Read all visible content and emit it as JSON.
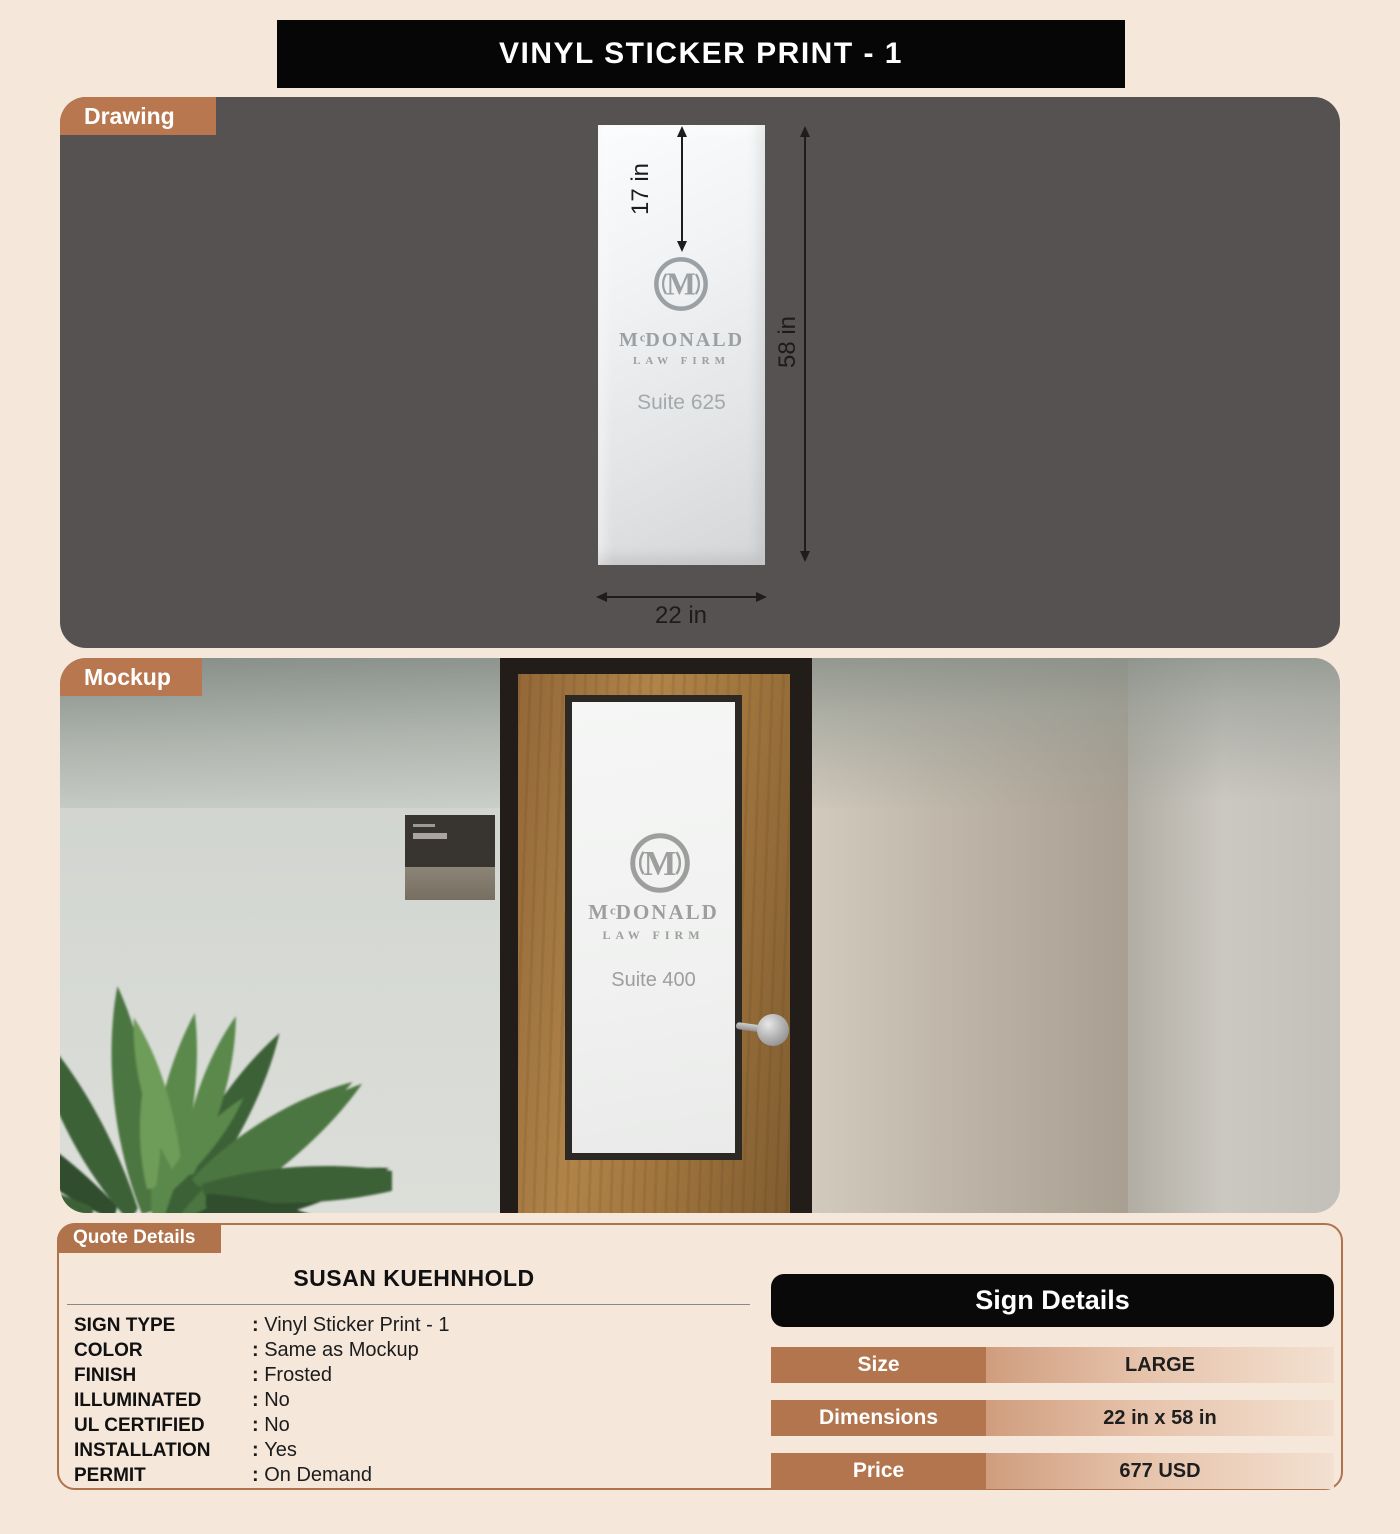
{
  "title": "VINYL STICKER PRINT - 1",
  "tabs": {
    "drawing": "Drawing",
    "mockup": "Mockup",
    "quote": "Quote Details"
  },
  "drawing": {
    "dims": {
      "logo_offset": "17 in",
      "height": "58 in",
      "width": "22 in"
    },
    "sign": {
      "monogram": "M",
      "name_m": "M",
      "name_c": "c",
      "name_rest": "DONALD",
      "tagline": "LAW FIRM",
      "suite": "Suite 625"
    }
  },
  "mockup": {
    "sign": {
      "monogram": "M",
      "name_m": "M",
      "name_c": "c",
      "name_rest": "DONALD",
      "tagline": "LAW FIRM",
      "suite": "Suite 400"
    }
  },
  "quote": {
    "customer": "SUSAN KUEHNHOLD",
    "specs": [
      {
        "label": "SIGN TYPE",
        "value": "Vinyl Sticker Print - 1"
      },
      {
        "label": "COLOR",
        "value": "Same as Mockup"
      },
      {
        "label": "FINISH",
        "value": "Frosted"
      },
      {
        "label": "ILLUMINATED",
        "value": "No"
      },
      {
        "label": "UL CERTIFIED",
        "value": "No"
      },
      {
        "label": "INSTALLATION",
        "value": "Yes"
      },
      {
        "label": "PERMIT",
        "value": "On Demand"
      }
    ],
    "sign_details": {
      "title": "Sign Details",
      "rows": [
        {
          "label": "Size",
          "value": "LARGE"
        },
        {
          "label": "Dimensions",
          "value": "22 in x 58 in"
        },
        {
          "label": "Price",
          "value": "677 USD"
        }
      ]
    }
  },
  "colors": {
    "page_bg": "#f6e7db",
    "title_bg": "#060606",
    "tab_brown": "#b8774f",
    "drawing_bg": "#555251",
    "logo_gray": "#9aa0a3",
    "sd_label_brown": "#b3754e",
    "sd_value_gradient_start": "#d09d7e",
    "sd_value_gradient_end": "#f3e0d0",
    "quote_border": "#b0734c"
  }
}
